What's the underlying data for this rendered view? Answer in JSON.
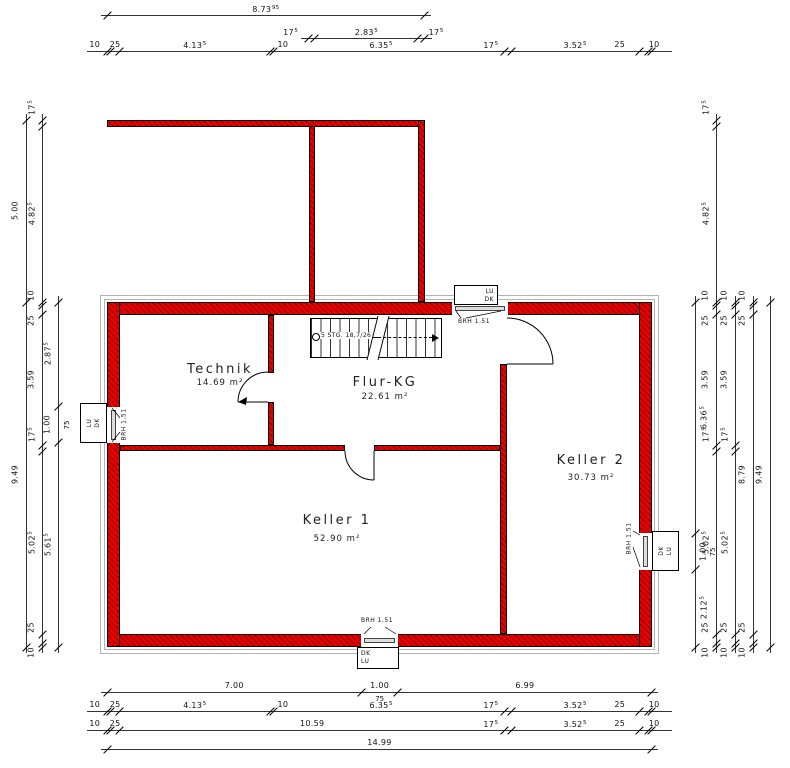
{
  "plan": {
    "scale": 36.355,
    "background": "#ffffff"
  },
  "colors": {
    "wall_fill": "#e60000",
    "wall_hatch": "#8f0000",
    "wall_outline": "#000000",
    "casing": "#b4b4b4",
    "dim_line": "#333333",
    "dim_text": "#111111",
    "window_frame": "#dcdcdc"
  },
  "rooms": [
    {
      "id": "technik",
      "name": "Technik",
      "area": "14.69 m²",
      "cx": 220,
      "cy": 370,
      "ay": 384
    },
    {
      "id": "flur-kg",
      "name": "Flur-KG",
      "area": "22.61 m²",
      "cx": 385,
      "cy": 383,
      "ay": 398
    },
    {
      "id": "keller-1",
      "name": "Keller 1",
      "area": "52.90 m²",
      "cx": 337,
      "cy": 521,
      "ay": 540
    },
    {
      "id": "keller-2",
      "name": "Keller 2",
      "area": "30.73 m²",
      "cx": 591,
      "cy": 461,
      "ay": 479
    }
  ],
  "stair": {
    "label": "5 STG. 18,7/26"
  },
  "windows": [
    {
      "id": "top",
      "gap": {
        "x": 452,
        "y": 302,
        "w": 56,
        "h": 13
      },
      "frame": {
        "x": 455,
        "y": 306,
        "w": 50,
        "h": 5
      },
      "box": {
        "x": 454,
        "y": 285,
        "w": 44,
        "h": 20
      },
      "labels": [
        "LU",
        "DK"
      ],
      "orient": "h",
      "align": "right",
      "brh": {
        "text": "BRH 1.51",
        "x": 474,
        "y": 322,
        "rot": 0
      },
      "leaders": [
        [
          461,
          318,
          456,
          311
        ],
        [
          466,
          318,
          501,
          311
        ]
      ]
    },
    {
      "id": "left",
      "gap": {
        "x": 107,
        "y": 407,
        "w": 13,
        "h": 36
      },
      "frame": {
        "x": 111,
        "y": 410,
        "w": 5,
        "h": 30
      },
      "box": {
        "x": 80,
        "y": 403,
        "w": 27,
        "h": 40
      },
      "labels": [
        "LU",
        "DK"
      ],
      "orient": "v",
      "brh": {
        "text": "BRH 1.51",
        "x": 124,
        "y": 425,
        "rot": -90
      },
      "leaders": [
        [
          120,
          418,
          112,
          408
        ],
        [
          120,
          432,
          112,
          442
        ]
      ]
    },
    {
      "id": "right",
      "gap": {
        "x": 639,
        "y": 533,
        "w": 13,
        "h": 37
      },
      "frame": {
        "x": 643,
        "y": 536,
        "w": 5,
        "h": 31
      },
      "box": {
        "x": 652,
        "y": 531,
        "w": 27,
        "h": 40
      },
      "labels": [
        "DK",
        "LU"
      ],
      "orient": "v",
      "brh": {
        "text": "BRH 1.51",
        "x": 629,
        "y": 539,
        "rot": -90
      },
      "leaders": [
        [
          633,
          531,
          640,
          535
        ],
        [
          633,
          547,
          640,
          567
        ]
      ]
    },
    {
      "id": "bottom",
      "gap": {
        "x": 361,
        "y": 634,
        "w": 37,
        "h": 13
      },
      "frame": {
        "x": 364,
        "y": 638,
        "w": 31,
        "h": 5
      },
      "box": {
        "x": 357,
        "y": 647,
        "w": 42,
        "h": 22
      },
      "labels": [
        "DK",
        "LU"
      ],
      "orient": "h",
      "align": "left",
      "brh": {
        "text": "BRH 1.51",
        "x": 377,
        "y": 621,
        "rot": 0
      },
      "leaders": [
        [
          371,
          627,
          364,
          634
        ],
        [
          385,
          627,
          396,
          634
        ]
      ]
    }
  ],
  "dim_chains": [
    {
      "id": "top-overall",
      "axis": "h",
      "line": 15,
      "from": 107,
      "ext": 6,
      "segs": [
        {
          "m": 8.7395,
          "t": "8.73",
          "s": "95"
        }
      ]
    },
    {
      "id": "top-stair",
      "axis": "h",
      "line": 38,
      "from": 308.5,
      "ext": 8,
      "segs": [
        {
          "m": 0.175,
          "t": "17",
          "s": "5",
          "dx": -21
        },
        {
          "m": 2.835,
          "t": "2.83",
          "s": "5"
        },
        {
          "m": 0.175,
          "t": "17",
          "s": "5",
          "dx": 15
        }
      ]
    },
    {
      "id": "top-detail",
      "axis": "h",
      "line": 51,
      "from": 107,
      "ext": 20,
      "segs": [
        {
          "m": 0.1,
          "t": "10",
          "dx": -14
        },
        {
          "m": 0.25,
          "t": "25"
        },
        {
          "m": 4.135,
          "t": "4.13",
          "s": "5"
        },
        {
          "m": 0.1,
          "t": "10",
          "dx": 11
        },
        {
          "m": 6.355,
          "t": "6.35",
          "s": "5",
          "dx": -8
        },
        {
          "m": 0.175,
          "t": "17",
          "s": "5",
          "dx": -17
        },
        {
          "m": 3.525,
          "t": "3.52",
          "s": "5"
        },
        {
          "m": 0.25,
          "t": "25",
          "dx": -24
        },
        {
          "m": 0.1,
          "t": "10",
          "dx": 4
        }
      ]
    },
    {
      "id": "bottom-openings",
      "axis": "h",
      "line": 692,
      "from": 107,
      "ext": 6,
      "segs": [
        {
          "m": 7.0,
          "t": "7.00"
        },
        {
          "m": 1.0,
          "t": "1.00",
          "extra": "75"
        },
        {
          "m": 6.99,
          "t": "6.99"
        }
      ]
    },
    {
      "id": "bottom-detail",
      "axis": "h",
      "line": 711,
      "from": 107,
      "ext": 20,
      "segs": [
        {
          "m": 0.1,
          "t": "10",
          "dx": -14
        },
        {
          "m": 0.25,
          "t": "25"
        },
        {
          "m": 4.135,
          "t": "4.13",
          "s": "5"
        },
        {
          "m": 0.1,
          "t": "10",
          "dx": 11
        },
        {
          "m": 6.355,
          "t": "6.35",
          "s": "5",
          "dx": -8
        },
        {
          "m": 0.175,
          "t": "17",
          "s": "5",
          "dx": -17
        },
        {
          "m": 3.525,
          "t": "3.52",
          "s": "5"
        },
        {
          "m": 0.25,
          "t": "25",
          "dx": -24
        },
        {
          "m": 0.1,
          "t": "10",
          "dx": 4
        }
      ]
    },
    {
      "id": "bottom-inner",
      "axis": "h",
      "line": 730,
      "from": 107,
      "ext": 20,
      "segs": [
        {
          "m": 0.1,
          "t": "10",
          "dx": -14
        },
        {
          "m": 0.25,
          "t": "25"
        },
        {
          "m": 10.59,
          "t": "10.59"
        },
        {
          "m": 0.175,
          "t": "17",
          "s": "5",
          "dx": -17
        },
        {
          "m": 3.525,
          "t": "3.52",
          "s": "5"
        },
        {
          "m": 0.25,
          "t": "25",
          "dx": -24
        },
        {
          "m": 0.1,
          "t": "10",
          "dx": 4
        }
      ]
    },
    {
      "id": "bottom-overall",
      "axis": "h",
      "line": 749,
      "from": 107,
      "ext": 6,
      "segs": [
        {
          "m": 14.99,
          "t": "14.99"
        }
      ]
    },
    {
      "id": "left-overall",
      "axis": "v",
      "line": 26,
      "from": 120.3,
      "segs": [
        {
          "m": 5.0,
          "t": "5.00"
        },
        {
          "m": 9.49,
          "t": "9.49"
        }
      ]
    },
    {
      "id": "left-detail",
      "axis": "v",
      "line": 42,
      "from": 120.3,
      "segs": [
        {
          "m": 0.175,
          "t": "17",
          "s": "5",
          "dy": -15
        },
        {
          "m": 4.825,
          "t": "4.82",
          "s": "5"
        },
        {
          "m": 0.1,
          "t": "10",
          "dy": -8
        },
        {
          "m": 0.25,
          "t": "25",
          "dy": 11
        },
        {
          "m": 3.59,
          "t": "3.59"
        },
        {
          "m": 0.175,
          "t": "17",
          "s": "5",
          "dy": -13
        },
        {
          "m": 5.025,
          "t": "5.02",
          "s": "5"
        },
        {
          "m": 0.25,
          "t": "25",
          "dy": -11
        },
        {
          "m": 0.1,
          "t": "10",
          "dy": 8
        }
      ]
    },
    {
      "id": "left-window",
      "axis": "v",
      "line": 58,
      "from": 302,
      "ex": 9,
      "segs": [
        {
          "m": 2.875,
          "t": "2.87",
          "s": "5"
        },
        {
          "m": 1.0,
          "t": "1.00",
          "extra": "75"
        },
        {
          "m": 5.615,
          "t": "5.61",
          "s": "5"
        }
      ]
    },
    {
      "id": "right-window",
      "axis": "v",
      "line": 695,
      "lx": 8,
      "ex": 18,
      "from": 302,
      "segs": [
        {
          "m": 6.365,
          "t": "6.36",
          "s": "5"
        },
        {
          "m": 1.0,
          "t": "1.00",
          "extra": "75"
        },
        {
          "m": 2.125,
          "t": "2.12",
          "s": "5"
        }
      ]
    },
    {
      "id": "right-detail-1",
      "axis": "v",
      "line": 716,
      "from": 120.3,
      "segs": [
        {
          "m": 0.175,
          "t": "17",
          "s": "5",
          "dy": -15
        },
        {
          "m": 4.825,
          "t": "4.82",
          "s": "5"
        },
        {
          "m": 0.1,
          "t": "10",
          "dy": -8
        },
        {
          "m": 0.25,
          "t": "25",
          "dy": 11
        },
        {
          "m": 3.59,
          "t": "3.59"
        },
        {
          "m": 0.175,
          "t": "17",
          "s": "5",
          "dy": -13
        },
        {
          "m": 5.025,
          "t": "5.02",
          "s": "5"
        },
        {
          "m": 0.25,
          "t": "25",
          "dy": -11
        },
        {
          "m": 0.1,
          "t": "10",
          "dy": 8
        }
      ]
    },
    {
      "id": "right-detail-2",
      "axis": "v",
      "line": 735,
      "from": 302,
      "segs": [
        {
          "m": 0.1,
          "t": "10",
          "dy": -8
        },
        {
          "m": 0.25,
          "t": "25",
          "dy": 11
        },
        {
          "m": 3.59,
          "t": "3.59"
        },
        {
          "m": 0.175,
          "t": "17",
          "s": "5",
          "dy": -13
        },
        {
          "m": 5.025,
          "t": "5.02",
          "s": "5"
        },
        {
          "m": 0.25,
          "t": "25",
          "dy": -11
        },
        {
          "m": 0.1,
          "t": "10",
          "dy": 8
        }
      ]
    },
    {
      "id": "right-inner",
      "axis": "v",
      "line": 753,
      "from": 302,
      "segs": [
        {
          "m": 0.1,
          "t": "10",
          "dy": -8
        },
        {
          "m": 0.25,
          "t": "25",
          "dy": 11
        },
        {
          "m": 8.79,
          "t": "8.79"
        },
        {
          "m": 0.25,
          "t": "25",
          "dy": -11
        },
        {
          "m": 0.1,
          "t": "10",
          "dy": 8
        }
      ]
    },
    {
      "id": "right-overall",
      "axis": "v",
      "line": 770,
      "from": 302,
      "segs": [
        {
          "m": 9.49,
          "t": "9.49"
        }
      ]
    }
  ]
}
